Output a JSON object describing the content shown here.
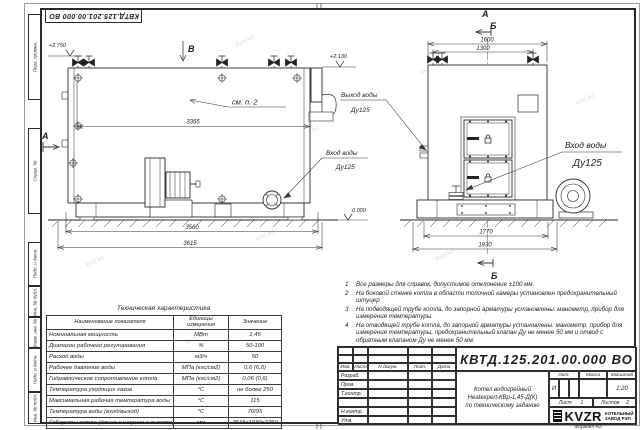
{
  "meta": {
    "doc_number": "КВТД.125.201.00.000 ВО",
    "format_label": "Формат А3"
  },
  "watermark": {
    "text": "kvzr.kz"
  },
  "frame": {
    "left_labels": [
      "Перв. примен.",
      "Справ. №",
      "Подп. и дата",
      "Инв. № дубл.",
      "Взам. инв. №",
      "Подп. и дата",
      "Инв. № подл."
    ]
  },
  "views": {
    "side": {
      "view_b": "В",
      "section_a": "А",
      "see_note": "см. п. 2",
      "dim_3365": "3365",
      "dim_3560": "3560",
      "dim_3615": "3615",
      "level_top": "+2.750",
      "level_flue": "+2.130",
      "level_ground": "0.000",
      "inlet1": "Вход воды",
      "inlet2": "Ду125"
    },
    "front": {
      "mark_a": "А",
      "mark_b": "Б",
      "mark_b_bottom": "Б",
      "dim_1600": "1600",
      "dim_1300": "1300",
      "dim_1770": "1770",
      "dim_1930": "1930",
      "outlet1": "Выход воды",
      "outlet2": "Ду125",
      "inlet1": "Вход воды",
      "inlet2": "Ду125"
    }
  },
  "tech_table": {
    "title": "Техническая характеристика",
    "header_name": "Наименование показателя",
    "header_unit": "Единицы измерения",
    "header_value": "Значение",
    "rows": [
      {
        "name": "Номинальная мощность",
        "unit": "МВт",
        "value": "1,45"
      },
      {
        "name": "Диапазон рабочего регулирования",
        "unit": "%",
        "value": "50-100"
      },
      {
        "name": "Расход воды",
        "unit": "м3/ч",
        "value": "50"
      },
      {
        "name": "Рабочее давление воды",
        "unit": "МПа (кгс/см2)",
        "value": "0,6 (6,0)"
      },
      {
        "name": "Гидравлическое сопротивление котла",
        "unit": "МПа (кгс/см2)",
        "value": "0,06 (0,6)"
      },
      {
        "name": "Температура уходящих газов",
        "unit": "°С",
        "value": "не более 250"
      },
      {
        "name": "Максимальная рабочая температура воды",
        "unit": "°С",
        "value": "115"
      },
      {
        "name": "Температура воды (вход/выход)",
        "unit": "°С",
        "value": "70/95"
      },
      {
        "name": "Габариты котла (длина х ширина х высота)",
        "unit": "мм",
        "value": "3615х1930х2250"
      }
    ]
  },
  "notes": {
    "items": [
      {
        "num": "1",
        "text": "Все размеры для справок, допустимое отклонение ±100 мм."
      },
      {
        "num": "2",
        "text": "На боковой стенке котла в области топочной камеры установлен предохранительный штуцер"
      },
      {
        "num": "3",
        "text": "На подводящей трубе котла, до запорной арматуры установлены: манометр, прибор для измерения температуры."
      },
      {
        "num": "4",
        "text": "На отводящей трубе котла, до запорной арматуры установлены: манометр, прибор для измерения температуры, предохранительный клапан Ду не менее 50 мм и отвод с обратным клапаном Ду не менее 50 мм."
      }
    ]
  },
  "title_block": {
    "doc_number": "КВТД.125.201.00.000 ВО",
    "product_line1": "Котел водогрейный",
    "product_line2": "Heatexpert-КВр-1,45-Д(К)",
    "product_line3": "по техническому заданию",
    "header_cells": [
      "Изм.",
      "Лист",
      "N докум.",
      "Подп.",
      "Дата"
    ],
    "sign_rows": [
      "Разраб.",
      "Пров.",
      "Т.контр.",
      "",
      "Н.контр.",
      "Утв."
    ],
    "lit_header": "Лит.",
    "mass_header": "Масса",
    "scale_header": "Масштаб",
    "lit_value": "И",
    "scale_value": "1:20",
    "sheet_label": "Лист",
    "sheet_value": "1",
    "sheets_label": "Листов",
    "sheets_value": "2",
    "logo_text": "KVZR",
    "logo_line1": "КОТЕЛЬНЫЙ",
    "logo_line2": "ЗАВОД РЭП"
  }
}
